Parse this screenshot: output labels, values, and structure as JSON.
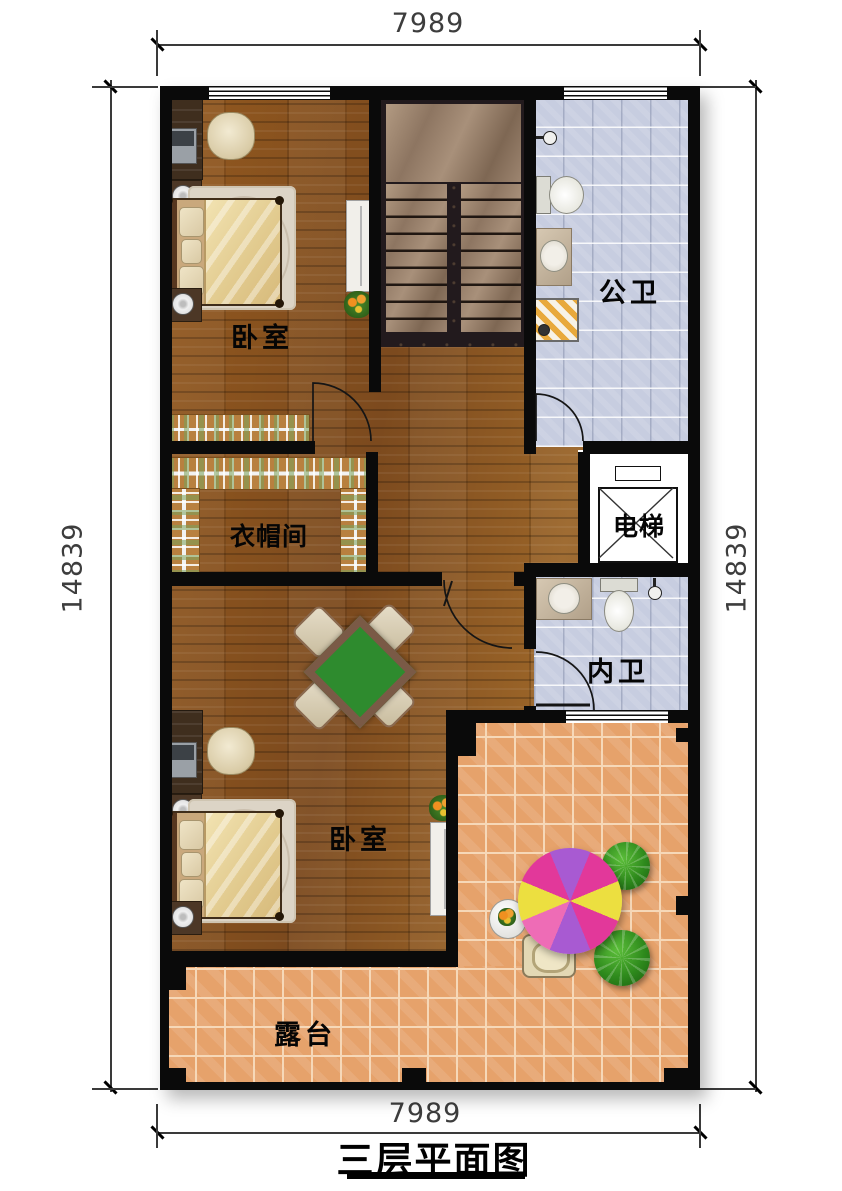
{
  "title": {
    "text": "三层平面图"
  },
  "dimensions": {
    "top": "7989",
    "bottom": "7989",
    "left": "14839",
    "right": "14839"
  },
  "rooms": {
    "bedroom_top": {
      "label": "卧室"
    },
    "public_bath": {
      "label": "公卫"
    },
    "cloakroom": {
      "label": "衣帽间"
    },
    "elevator": {
      "label": "电梯"
    },
    "private_bath": {
      "label": "内卫"
    },
    "bedroom_bottom": {
      "label": "卧室"
    },
    "terrace": {
      "label": "露台"
    }
  },
  "colors": {
    "wall": "#0a0a0a",
    "wood_floor": "#8a5526",
    "terrace_tile": "#e6a26b",
    "bath_tile": "#c7cde0",
    "stair_marble": "#9d8570",
    "stair_border": "#221a1d",
    "mahjong_green": "#2e8b2e",
    "umbrella_magenta": "#e2389a",
    "umbrella_purple": "#a85ad2",
    "umbrella_yellow": "#ecdf40",
    "bush_green": "#2e8a1c"
  }
}
